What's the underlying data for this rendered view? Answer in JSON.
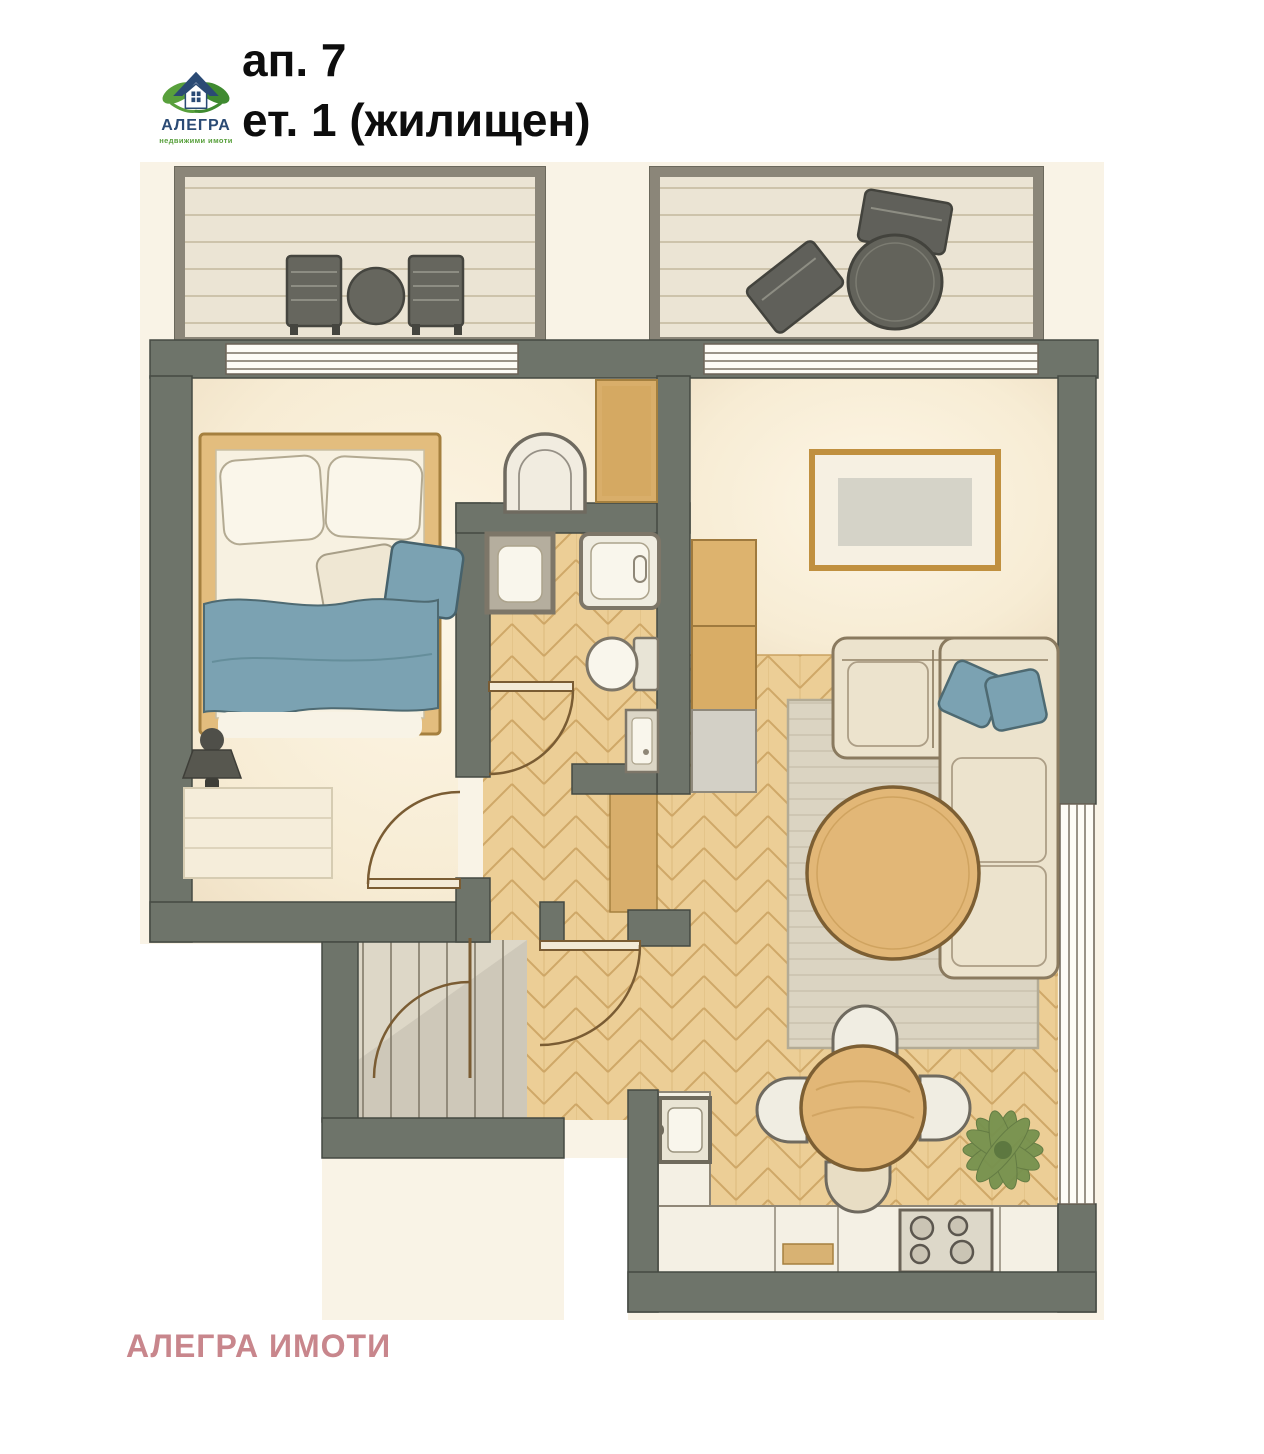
{
  "header": {
    "logo": {
      "name": "АЛЕГРА",
      "tagline": "недвижими имоти",
      "icon": "alegra-house-logo"
    },
    "apartment_label": "ап. 7",
    "floor_label": "ет. 1 (жилищен)"
  },
  "watermark": {
    "text": "АЛЕГРА ИМОТИ"
  },
  "floor_plan": {
    "type": "apartment-floor-plan-top-view",
    "style": "watercolor-illustration",
    "rooms": [
      {
        "id": "balcony-left",
        "label": "balcony",
        "floor": "wood-planks",
        "furniture": [
          "outdoor-chair",
          "round-table",
          "outdoor-chair"
        ]
      },
      {
        "id": "balcony-right",
        "label": "balcony",
        "floor": "wood-planks",
        "furniture": [
          "round-table",
          "outdoor-chair",
          "outdoor-chair"
        ]
      },
      {
        "id": "bedroom",
        "label": "bedroom",
        "floor": "cream",
        "furniture": [
          "double-bed",
          "white-pillows",
          "blue-pillow",
          "blue-blanket",
          "wall-lamp",
          "dresser",
          "armchair",
          "wardrobe"
        ]
      },
      {
        "id": "bathroom",
        "label": "bathroom",
        "floor": "herringbone-parquet",
        "furniture": [
          "washing-machine",
          "bathtub",
          "toilet",
          "cabinet"
        ]
      },
      {
        "id": "hallway",
        "label": "entrance-hall",
        "floor": "herringbone-parquet",
        "furniture": [
          "built-in-closet"
        ]
      },
      {
        "id": "staircase",
        "label": "staircase-landing",
        "floor": "stone",
        "furniture": [
          "stairs",
          "entrance-door"
        ]
      },
      {
        "id": "living-room",
        "label": "living-room",
        "floor": "herringbone-parquet",
        "furniture": [
          "wall-tv-panel",
          "corner-sofa",
          "blue-cushions",
          "rug",
          "round-coffee-table",
          "tall-cabinets",
          "fridge",
          "plant"
        ]
      },
      {
        "id": "kitchen-dining",
        "label": "kitchen-dining",
        "floor": "herringbone-parquet",
        "furniture": [
          "l-shaped-counter",
          "sink",
          "cooktop-4-burners",
          "round-dining-table",
          "chair",
          "chair",
          "chair",
          "chair"
        ]
      }
    ],
    "door_count": 4,
    "window_count": 3
  },
  "colors": {
    "background": "#ffffff",
    "paper": "#f9f3e6",
    "wall": "#6e746a",
    "wall_outline": "#454a43",
    "balcony_floor": "#ebe4d4",
    "balcony_border": "#8b8679",
    "room_floor": "#f8efdb",
    "wood_floor": "#ecce96",
    "wood_line": "#c89f5c",
    "furniture_wood": "#e2b777",
    "frame_wood": "#c0903f",
    "textile_blue": "#7ba2b2",
    "sofa_fabric": "#ece3cd",
    "rug": "#dbd4c2",
    "fixture_white": "#f9f6ec",
    "fixture_border": "#7d7668",
    "stair_floor": "#ddd7c7",
    "dark_furniture": "#62625a",
    "plant_green": "#76914e",
    "title_text": "#0d0d0d",
    "watermark_text": "#c8868c",
    "logo_navy": "#2a4a74",
    "logo_green": "#58a03c"
  }
}
